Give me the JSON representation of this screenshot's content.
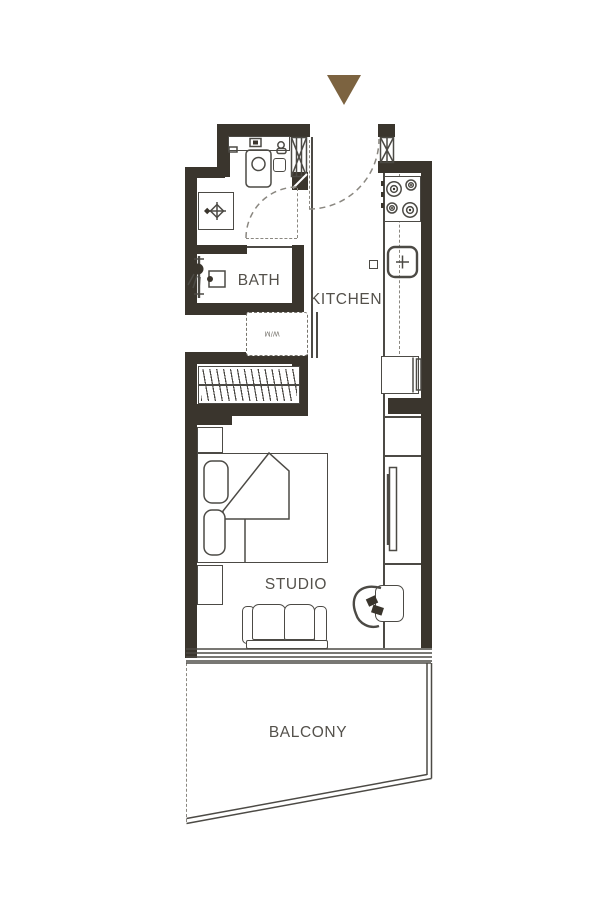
{
  "floor_plan": {
    "unit_type": "studio apartment floor plan",
    "entry": {
      "marker": "triangle-down"
    },
    "rooms": {
      "bath": {
        "label": "BATH"
      },
      "kitchen": {
        "label": "KITCHEN"
      },
      "studio": {
        "label": "STUDIO"
      },
      "balcony": {
        "label": "BALCONY"
      }
    },
    "fixtures": {
      "washing_machine": {
        "label": "W/M"
      },
      "bath_items": [
        "vanity-counter",
        "toilet",
        "wash-basin",
        "shower-bathtub"
      ],
      "kitchen_items": [
        "cooktop-4-burner",
        "kitchen-sink",
        "refrigerator"
      ],
      "studio_items": [
        "wardrobe-hangers",
        "double-bed",
        "nightstand",
        "sofa",
        "tv",
        "desk",
        "desk-chair"
      ]
    },
    "colors": {
      "wall": "#3a352d",
      "line": "#4c4a45",
      "label": "#54514b",
      "accent": "#7c6340",
      "background": "#ffffff"
    }
  }
}
